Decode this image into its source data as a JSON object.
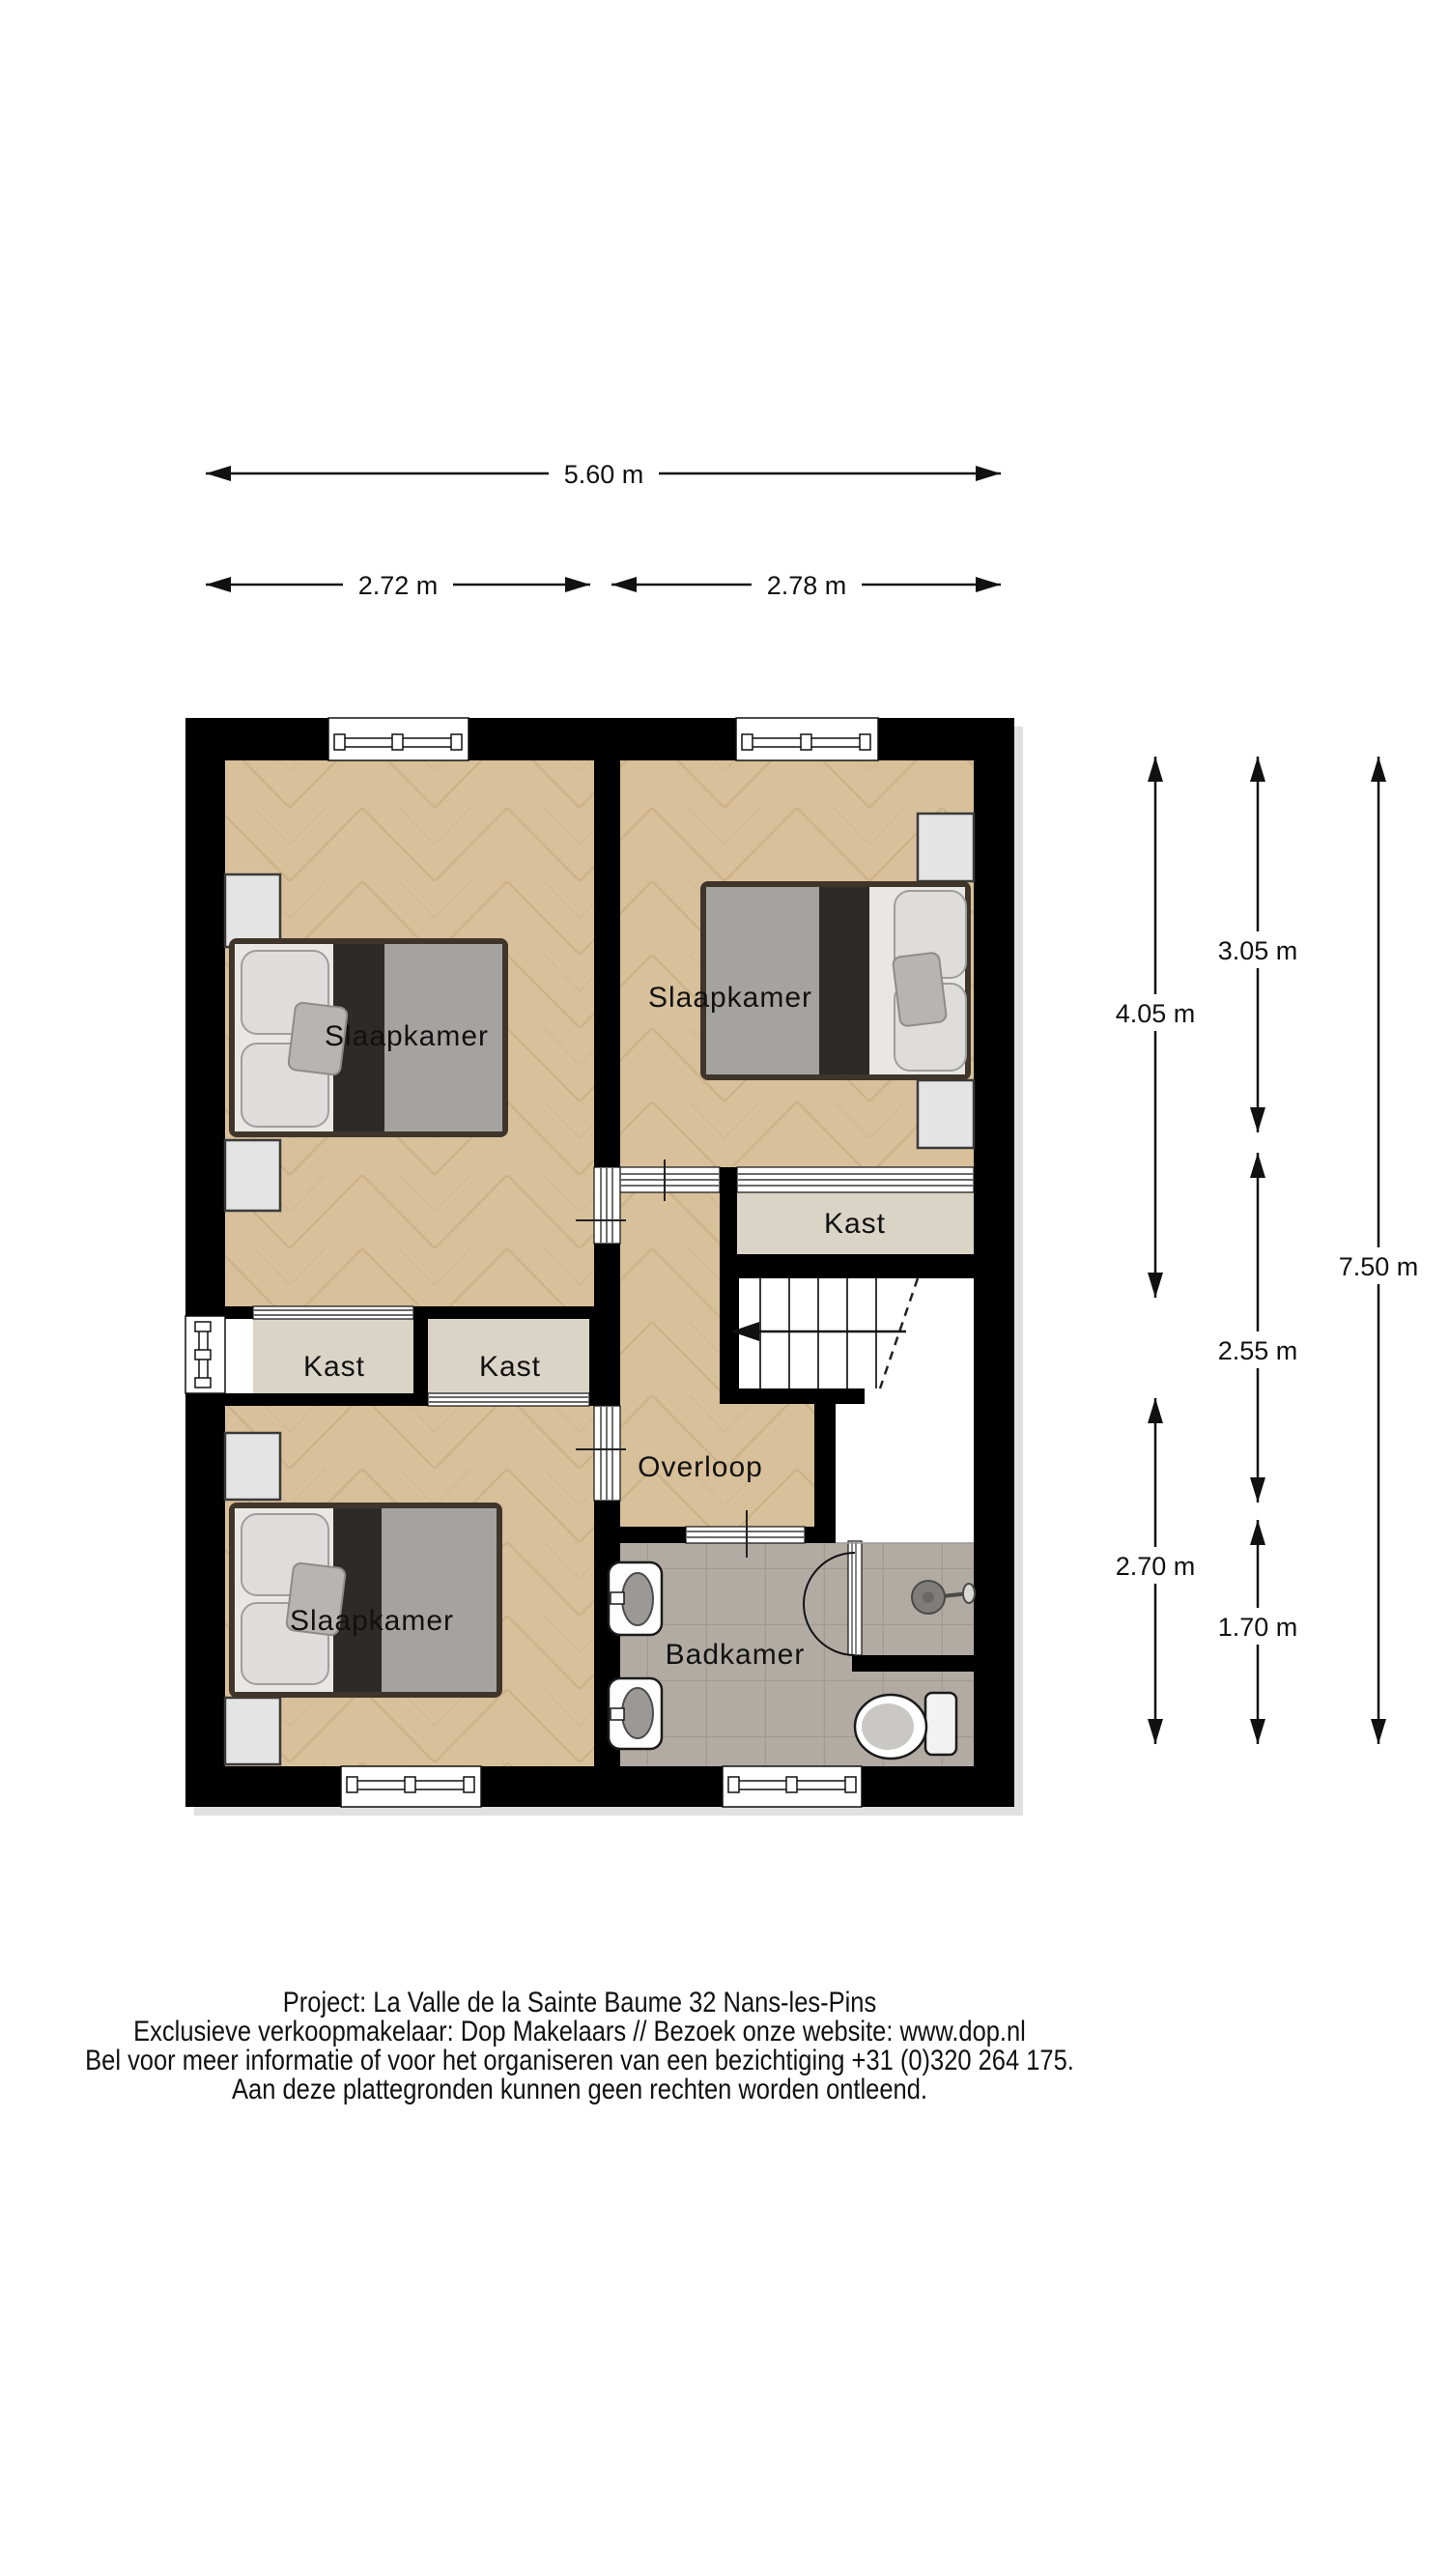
{
  "dims": {
    "top_total": "5.60 m",
    "top_left": "2.72 m",
    "top_right": "2.78 m",
    "right_col1_upper": "4.05 m",
    "right_col1_lower": "2.70 m",
    "right_col2_upper": "3.05 m",
    "right_col2_middle": "2.55 m",
    "right_col2_lower": "1.70 m",
    "right_total": "7.50 m"
  },
  "rooms": {
    "slaapkamer_top_left": "Slaapkamer",
    "slaapkamer_top_right": "Slaapkamer",
    "slaapkamer_bottom_left": "Slaapkamer",
    "kast_left": "Kast",
    "kast_middle": "Kast",
    "kast_right": "Kast",
    "overloop": "Overloop",
    "badkamer": "Badkamer"
  },
  "footer": {
    "line1": "Project: La Valle de la Sainte Baume 32  Nans-les-Pins",
    "line2": "Exclusieve verkoopmakelaar: Dop Makelaars // Bezoek onze website: www.dop.nl",
    "line3": "Bel voor meer informatie of voor het organiseren van een bezichtiging +31 (0)320 264 175.",
    "line4": "Aan deze plattegronden kunnen geen rechten worden ontleend."
  },
  "colors": {
    "wall": "#000000",
    "parquet": "#d8c09a",
    "parquet_line": "#c2a77c",
    "carpet": "#dad4c6",
    "tile": "#b2aba3",
    "tile_line": "#a29a92",
    "niche": "#e4e4e4",
    "dim_line": "#111111"
  }
}
